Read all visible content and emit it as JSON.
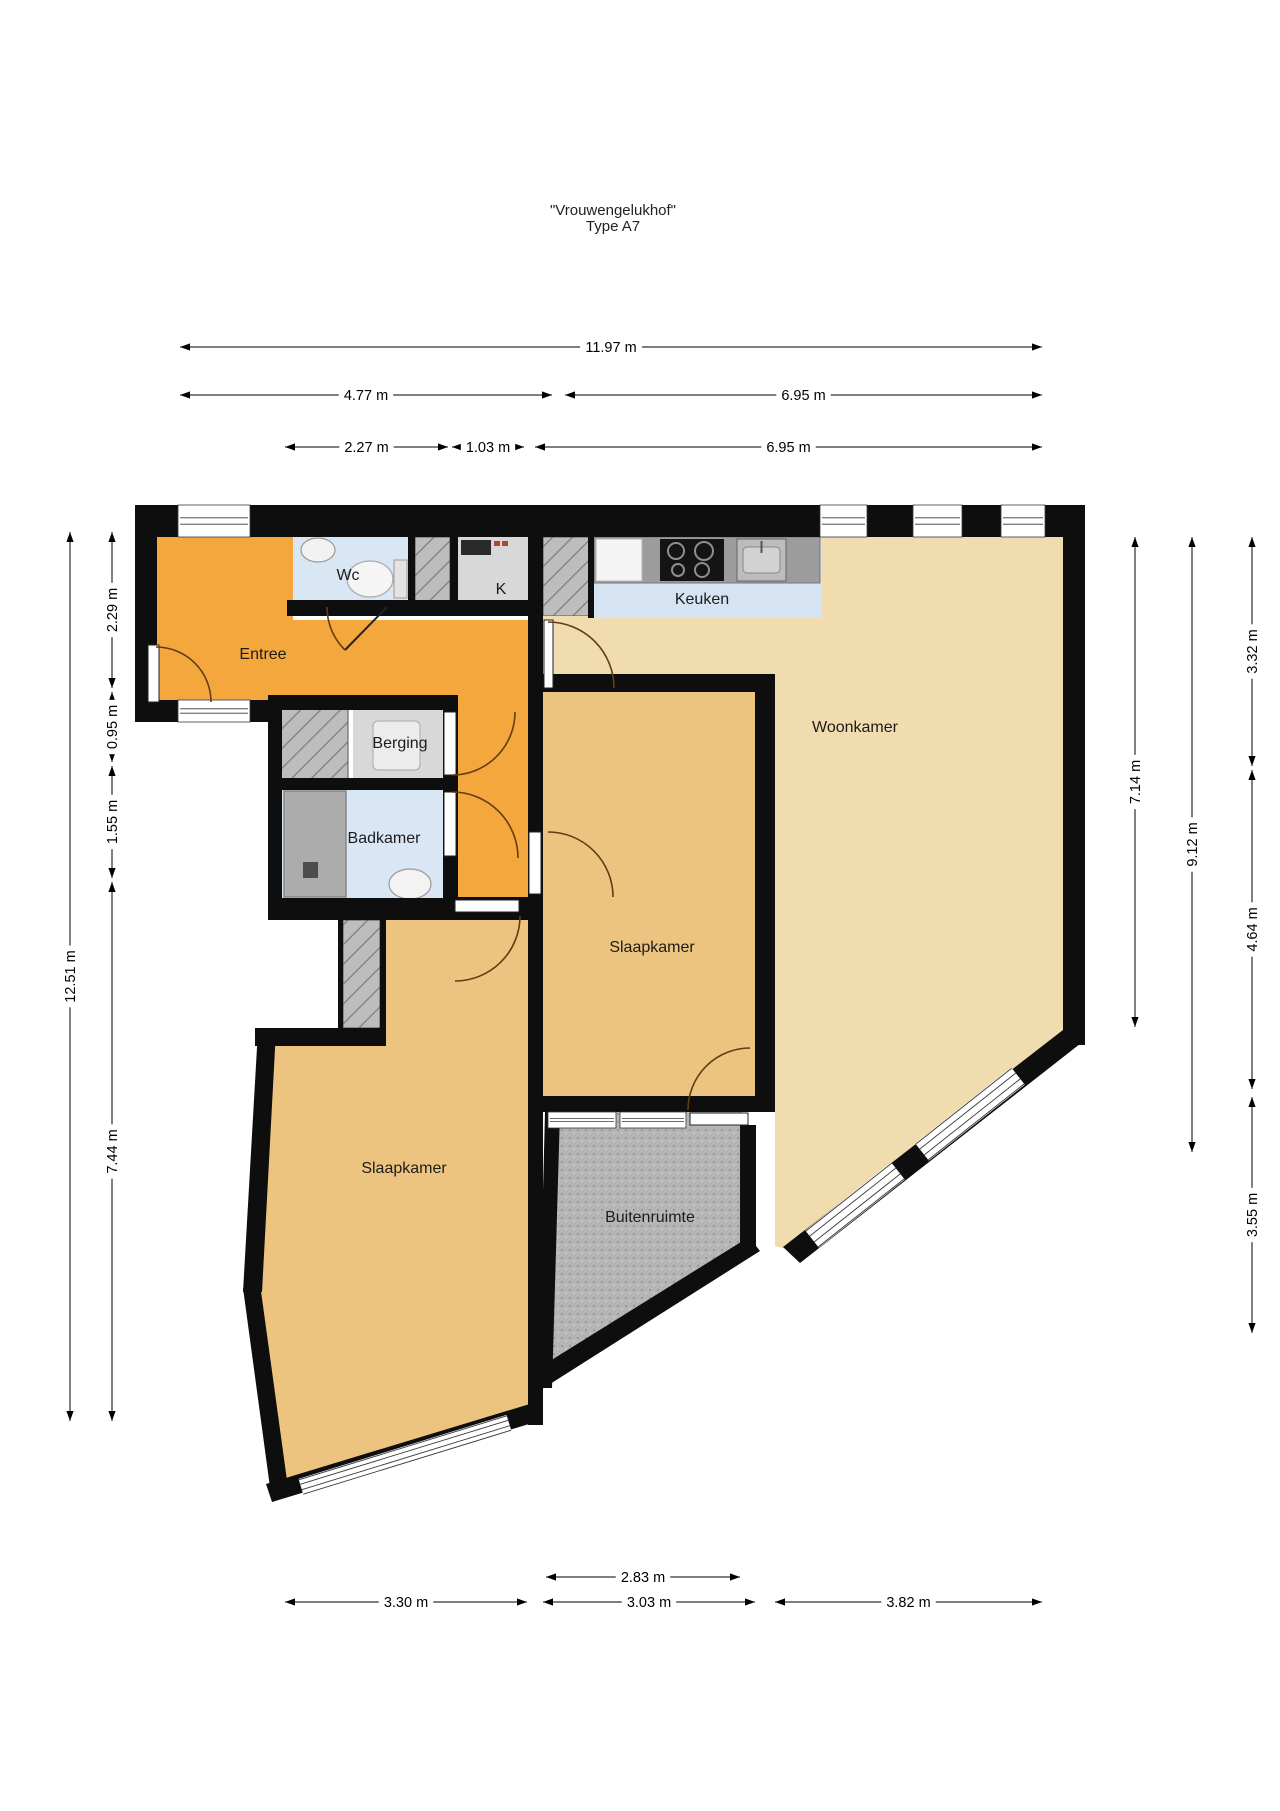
{
  "title": {
    "line1": "\"Vrouwengelukhof\"",
    "line2": "Type A7"
  },
  "floorplan": {
    "canvas": {
      "width": 1280,
      "height": 1811
    },
    "colors": {
      "wall": "#0e0e0e",
      "orange": "#F4A73D",
      "tan_light": "#F0DCAE",
      "tan": "#ECC47F",
      "blue": "#D9E6F4",
      "blue_kitchen": "#D5E3F2",
      "gray_floor": "#D8D8D8",
      "gray_counter": "#9C9C9C",
      "shower": "#ACACAC",
      "hatch_base": "#BDBDBD",
      "hatch_line": "#7d7d7d",
      "speckle_base": "#B5B5B5",
      "speckle_dot": "#9a9a9a",
      "door_arc": "#5f3d15",
      "frame": "#3a3a3a",
      "label": "#1c1c1c",
      "dim": "#000000"
    },
    "rooms": [
      {
        "id": "entree",
        "label": "Entree",
        "label_x": 263,
        "label_y": 659,
        "fill": "orange",
        "poly": [
          [
            157,
            537
          ],
          [
            293,
            537
          ],
          [
            293,
            620
          ],
          [
            543,
            620
          ],
          [
            543,
            910
          ],
          [
            443,
            910
          ],
          [
            443,
            700
          ],
          [
            157,
            700
          ]
        ]
      },
      {
        "id": "wc",
        "label": "Wc",
        "label_x": 348,
        "label_y": 580,
        "fill": "blue",
        "poly": [
          [
            293,
            537
          ],
          [
            408,
            537
          ],
          [
            408,
            608
          ],
          [
            293,
            608
          ]
        ]
      },
      {
        "id": "shaft-a",
        "label": "",
        "label_x": 0,
        "label_y": 0,
        "fill": "hatch",
        "poly": [
          [
            415,
            537
          ],
          [
            450,
            537
          ],
          [
            450,
            608
          ],
          [
            415,
            608
          ]
        ]
      },
      {
        "id": "kast",
        "label": "K",
        "label_x": 501,
        "label_y": 594,
        "fill": "gray_floor",
        "poly": [
          [
            458,
            537
          ],
          [
            528,
            537
          ],
          [
            528,
            608
          ],
          [
            458,
            608
          ]
        ]
      },
      {
        "id": "shaft-b",
        "label": "",
        "label_x": 0,
        "label_y": 0,
        "fill": "hatch",
        "poly": [
          [
            543,
            537
          ],
          [
            590,
            537
          ],
          [
            590,
            616
          ],
          [
            543,
            616
          ]
        ]
      },
      {
        "id": "keuken",
        "label": "Keuken",
        "label_x": 702,
        "label_y": 604,
        "fill": "blue_kitchen",
        "poly": [
          [
            592,
            537
          ],
          [
            822,
            537
          ],
          [
            822,
            618
          ],
          [
            592,
            618
          ]
        ]
      },
      {
        "id": "woonkamer",
        "label": "Woonkamer",
        "label_x": 855,
        "label_y": 732,
        "fill": "tan_light",
        "poly": [
          [
            543,
            616
          ],
          [
            592,
            616
          ],
          [
            592,
            618
          ],
          [
            822,
            618
          ],
          [
            822,
            537
          ],
          [
            1063,
            537
          ],
          [
            1063,
            1036
          ],
          [
            790,
            1250
          ],
          [
            775,
            1246
          ],
          [
            775,
            674
          ],
          [
            543,
            674
          ]
        ]
      },
      {
        "id": "berging",
        "label": "Berging",
        "label_x": 400,
        "label_y": 748,
        "fill": "gray_floor",
        "poly": [
          [
            353,
            708
          ],
          [
            448,
            708
          ],
          [
            448,
            780
          ],
          [
            353,
            780
          ]
        ]
      },
      {
        "id": "shaft-c",
        "label": "",
        "label_x": 0,
        "label_y": 0,
        "fill": "hatch",
        "poly": [
          [
            280,
            708
          ],
          [
            348,
            708
          ],
          [
            348,
            780
          ],
          [
            280,
            780
          ]
        ]
      },
      {
        "id": "badkamer",
        "label": "Badkamer",
        "label_x": 384,
        "label_y": 843,
        "fill": "blue",
        "poly": [
          [
            282,
            790
          ],
          [
            443,
            790
          ],
          [
            443,
            898
          ],
          [
            282,
            898
          ]
        ]
      },
      {
        "id": "shaft-d",
        "label": "",
        "label_x": 0,
        "label_y": 0,
        "fill": "hatch",
        "poly": [
          [
            343,
            920
          ],
          [
            380,
            920
          ],
          [
            380,
            1028
          ],
          [
            343,
            1028
          ]
        ]
      },
      {
        "id": "slaapkamer-2",
        "label": "Slaapkamer",
        "label_x": 652,
        "label_y": 952,
        "fill": "tan",
        "poly": [
          [
            543,
            692
          ],
          [
            775,
            692
          ],
          [
            775,
            1096
          ],
          [
            543,
            1096
          ]
        ]
      },
      {
        "id": "slaapkamer-1",
        "label": "Slaapkamer",
        "label_x": 404,
        "label_y": 1173,
        "fill": "tan",
        "poly": [
          [
            386,
            918
          ],
          [
            543,
            918
          ],
          [
            543,
            1420
          ],
          [
            272,
            1498
          ],
          [
            246,
            1290
          ],
          [
            260,
            1032
          ],
          [
            386,
            1032
          ]
        ]
      },
      {
        "id": "buitenruimte",
        "label": "Buitenruimte",
        "label_x": 650,
        "label_y": 1222,
        "fill": "speckle",
        "poly": [
          [
            548,
            1112
          ],
          [
            742,
            1112
          ],
          [
            752,
            1240
          ],
          [
            533,
            1378
          ]
        ]
      }
    ],
    "counters": [
      {
        "id": "kitchen-counter",
        "x": 594,
        "y": 537,
        "w": 226,
        "h": 46,
        "fill": "gray_counter"
      }
    ],
    "walls_rects": [
      {
        "x": 135,
        "y": 505,
        "w": 950,
        "h": 32
      },
      {
        "x": 1063,
        "y": 505,
        "w": 22,
        "h": 540
      },
      {
        "x": 135,
        "y": 505,
        "w": 22,
        "h": 217
      },
      {
        "x": 135,
        "y": 700,
        "w": 137,
        "h": 22
      },
      {
        "x": 268,
        "y": 700,
        "w": 14,
        "h": 220
      },
      {
        "x": 268,
        "y": 898,
        "w": 190,
        "h": 22
      },
      {
        "x": 268,
        "y": 695,
        "w": 190,
        "h": 15
      },
      {
        "x": 268,
        "y": 778,
        "w": 190,
        "h": 12
      },
      {
        "x": 443,
        "y": 695,
        "w": 15,
        "h": 202
      },
      {
        "x": 443,
        "y": 897,
        "w": 100,
        "h": 23
      },
      {
        "x": 528,
        "y": 537,
        "w": 15,
        "h": 888
      },
      {
        "x": 287,
        "y": 600,
        "w": 256,
        "h": 16
      },
      {
        "x": 408,
        "y": 537,
        "w": 7,
        "h": 71
      },
      {
        "x": 450,
        "y": 537,
        "w": 8,
        "h": 71
      },
      {
        "x": 588,
        "y": 537,
        "w": 6,
        "h": 81
      },
      {
        "x": 543,
        "y": 674,
        "w": 232,
        "h": 18
      },
      {
        "x": 755,
        "y": 674,
        "w": 20,
        "h": 436
      },
      {
        "x": 543,
        "y": 1096,
        "w": 232,
        "h": 16
      },
      {
        "x": 740,
        "y": 1125,
        "w": 16,
        "h": 128
      },
      {
        "x": 255,
        "y": 1028,
        "w": 131,
        "h": 18
      },
      {
        "x": 338,
        "y": 920,
        "w": 5,
        "h": 126
      },
      {
        "x": 380,
        "y": 920,
        "w": 6,
        "h": 126
      }
    ],
    "walls_polys": [
      {
        "pts": [
          [
            243,
            1292
          ],
          [
            258,
            1030
          ],
          [
            276,
            1030
          ],
          [
            262,
            1292
          ]
        ]
      },
      {
        "pts": [
          [
            243,
            1288
          ],
          [
            272,
            1502
          ],
          [
            289,
            1495
          ],
          [
            260,
            1284
          ]
        ]
      },
      {
        "pts": [
          [
            272,
            1502
          ],
          [
            539,
            1421
          ],
          [
            533,
            1403
          ],
          [
            266,
            1484
          ]
        ]
      },
      {
        "pts": [
          [
            545,
            1112
          ],
          [
            560,
            1112
          ],
          [
            552,
            1388
          ],
          [
            538,
            1388
          ]
        ]
      },
      {
        "pts": [
          [
            539,
            1391
          ],
          [
            760,
            1251
          ],
          [
            749,
            1237
          ],
          [
            529,
            1374
          ]
        ]
      },
      {
        "pts": [
          [
            1063,
            1030
          ],
          [
            1085,
            1040
          ],
          [
            800,
            1263
          ],
          [
            783,
            1247
          ]
        ]
      }
    ],
    "windows_rects": [
      {
        "x": 178,
        "y": 505,
        "w": 72,
        "h": 32,
        "dir": "h"
      },
      {
        "x": 820,
        "y": 505,
        "w": 47,
        "h": 32,
        "dir": "h"
      },
      {
        "x": 913,
        "y": 505,
        "w": 49,
        "h": 32,
        "dir": "h"
      },
      {
        "x": 1001,
        "y": 505,
        "w": 44,
        "h": 32,
        "dir": "h"
      },
      {
        "x": 178,
        "y": 700,
        "w": 72,
        "h": 22,
        "dir": "h"
      },
      {
        "x": 548,
        "y": 1112,
        "w": 68,
        "h": 16,
        "dir": "h"
      },
      {
        "x": 620,
        "y": 1112,
        "w": 66,
        "h": 16,
        "dir": "h"
      }
    ],
    "windows_segs": [
      {
        "x1": 1018,
        "y1": 1076,
        "x2": 922,
        "y2": 1152,
        "w": 22
      },
      {
        "x1": 898,
        "y1": 1171,
        "x2": 812,
        "y2": 1239,
        "w": 22
      },
      {
        "x1": 301,
        "y1": 1487,
        "x2": 509,
        "y2": 1423,
        "w": 17
      }
    ],
    "doors": [
      {
        "id": "front-door",
        "leaf": {
          "x": 148,
          "y": 645,
          "w": 11,
          "h": 57
        },
        "arc": "M156,647 A55,55 0 0 1 211,702"
      },
      {
        "id": "wc-door",
        "leaf": null,
        "line": [
          387,
          607,
          345,
          650
        ],
        "arc": "M327,607 A60,60 0 0 0 345,650"
      },
      {
        "id": "woonkamer-door",
        "leaf": {
          "x": 544,
          "y": 620,
          "w": 9,
          "h": 68
        },
        "arc": "M548,622 A66,66 0 0 1 614,688"
      },
      {
        "id": "berging-door",
        "leaf": {
          "x": 444,
          "y": 712,
          "w": 12,
          "h": 63
        },
        "arc": "M452,775 A63,63 0 0 0 515,712"
      },
      {
        "id": "badkamer-door",
        "leaf": {
          "x": 444,
          "y": 792,
          "w": 12,
          "h": 64
        },
        "arc": "M452,792 A66,66 0 0 1 518,858"
      },
      {
        "id": "slaapkamer-2-door",
        "leaf": {
          "x": 529,
          "y": 832,
          "w": 12,
          "h": 62
        },
        "arc": "M548,832 A65,65 0 0 1 613,897"
      },
      {
        "id": "slaapkamer-1-door",
        "leaf": {
          "x": 455,
          "y": 900,
          "w": 64,
          "h": 12
        },
        "arc": "M520,916 A65,65 0 0 1 455,981"
      },
      {
        "id": "buitenruimte-door",
        "leaf": {
          "x": 690,
          "y": 1113,
          "w": 58,
          "h": 12
        },
        "arc": "M688,1110 A62,62 0 0 1 750,1048"
      }
    ],
    "fixtures": {
      "wc_sink": {
        "cx": 318,
        "cy": 550,
        "rx": 17,
        "ry": 12
      },
      "toilet": {
        "tank": {
          "x": 394,
          "y": 560,
          "w": 13,
          "h": 38
        },
        "bowl": {
          "cx": 370,
          "cy": 579,
          "rx": 23,
          "ry": 18
        }
      },
      "k_appliance": {
        "x": 461,
        "y": 540,
        "w": 30,
        "h": 15
      },
      "k_red_items": [
        {
          "x": 494,
          "y": 541,
          "w": 6,
          "h": 5
        },
        {
          "x": 502,
          "y": 541,
          "w": 6,
          "h": 5
        }
      ],
      "fridge": {
        "x": 596,
        "y": 539,
        "w": 46,
        "h": 42
      },
      "cooktop": {
        "x": 660,
        "y": 539,
        "w": 64,
        "h": 42,
        "burners": [
          [
            676,
            551,
            8
          ],
          [
            704,
            551,
            9
          ],
          [
            678,
            570,
            6
          ],
          [
            702,
            570,
            7
          ]
        ]
      },
      "kitchen_sink": {
        "x": 737,
        "y": 539,
        "w": 49,
        "h": 42
      },
      "washer": {
        "x": 373,
        "y": 721,
        "w": 47,
        "h": 49
      },
      "shower": {
        "x": 284,
        "y": 791,
        "w": 62,
        "h": 106,
        "drain": {
          "x": 303,
          "y": 862,
          "w": 15,
          "h": 16
        }
      },
      "bath_sink": {
        "cx": 410,
        "cy": 884,
        "rx": 21,
        "ry": 15
      }
    },
    "dimensions": [
      {
        "id": "top-total",
        "label": "11.97 m",
        "x1": 180,
        "y1": 347,
        "x2": 1042,
        "y2": 347
      },
      {
        "id": "top-left",
        "label": "4.77 m",
        "x1": 180,
        "y1": 395,
        "x2": 552,
        "y2": 395
      },
      {
        "id": "top-right",
        "label": "6.95 m",
        "x1": 565,
        "y1": 395,
        "x2": 1042,
        "y2": 395
      },
      {
        "id": "top-r3a",
        "label": "2.27 m",
        "x1": 285,
        "y1": 447,
        "x2": 448,
        "y2": 447
      },
      {
        "id": "top-r3b",
        "label": "1.03 m",
        "x1": 452,
        "y1": 447,
        "x2": 524,
        "y2": 447
      },
      {
        "id": "top-r3c",
        "label": "6.95 m",
        "x1": 535,
        "y1": 447,
        "x2": 1042,
        "y2": 447
      },
      {
        "id": "left-total",
        "label": "12.51 m",
        "x1": 70,
        "y1": 1421,
        "x2": 70,
        "y2": 532
      },
      {
        "id": "left-1",
        "label": "2.29 m",
        "x1": 112,
        "y1": 688,
        "x2": 112,
        "y2": 532
      },
      {
        "id": "left-2",
        "label": "0.95 m",
        "x1": 112,
        "y1": 762,
        "x2": 112,
        "y2": 692
      },
      {
        "id": "left-3",
        "label": "1.55 m",
        "x1": 112,
        "y1": 878,
        "x2": 112,
        "y2": 766
      },
      {
        "id": "left-4",
        "label": "7.44 m",
        "x1": 112,
        "y1": 1421,
        "x2": 112,
        "y2": 882
      },
      {
        "id": "right-1",
        "label": "7.14 m",
        "x1": 1135,
        "y1": 1027,
        "x2": 1135,
        "y2": 537
      },
      {
        "id": "right-2",
        "label": "9.12 m",
        "x1": 1192,
        "y1": 1152,
        "x2": 1192,
        "y2": 537
      },
      {
        "id": "right-3",
        "label": "3.32 m",
        "x1": 1252,
        "y1": 766,
        "x2": 1252,
        "y2": 537
      },
      {
        "id": "right-4",
        "label": "4.64 m",
        "x1": 1252,
        "y1": 1089,
        "x2": 1252,
        "y2": 770
      },
      {
        "id": "right-5",
        "label": "3.55 m",
        "x1": 1252,
        "y1": 1333,
        "x2": 1252,
        "y2": 1097
      },
      {
        "id": "bottom-buiten",
        "label": "2.83 m",
        "x1": 546,
        "y1": 1577,
        "x2": 740,
        "y2": 1577
      },
      {
        "id": "bottom-1",
        "label": "3.30 m",
        "x1": 285,
        "y1": 1602,
        "x2": 527,
        "y2": 1602
      },
      {
        "id": "bottom-2",
        "label": "3.03 m",
        "x1": 543,
        "y1": 1602,
        "x2": 755,
        "y2": 1602
      },
      {
        "id": "bottom-3",
        "label": "3.82 m",
        "x1": 775,
        "y1": 1602,
        "x2": 1042,
        "y2": 1602
      }
    ]
  }
}
